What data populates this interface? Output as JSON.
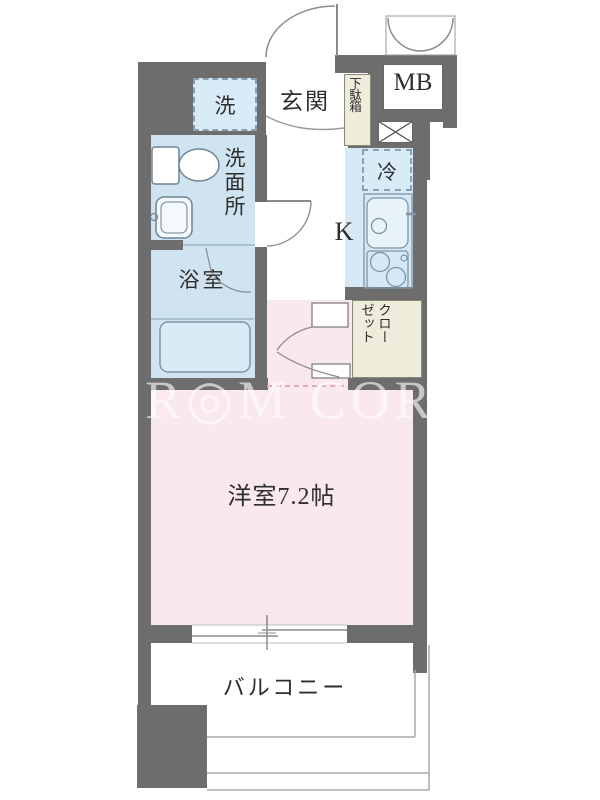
{
  "watermark": "R◎M CORE",
  "labels": {
    "entrance": "玄関",
    "meter_box": "MB",
    "washer": "洗",
    "shoe_cabinet": "下駄箱",
    "washroom": "洗面所",
    "bathroom": "浴室",
    "refrigerator": "冷",
    "kitchen": "K",
    "closet_col1": "クロー",
    "closet_col2": "ゼット",
    "main_room": "洋室7.2帖",
    "balcony": "バルコニー"
  },
  "colors": {
    "wall": "#6d6d6d",
    "wet_area_blue": "#cfe3f0",
    "kitchen_blue": "#d6e8f5",
    "room_pink": "#f9e8ee",
    "cabinet_beige": "#efecdc",
    "line_gray": "#8b8b8b",
    "text": "#2e2e2e",
    "dashed_border": "#86a0b5",
    "watermark_white": "rgba(255,255,255,0.62)"
  }
}
